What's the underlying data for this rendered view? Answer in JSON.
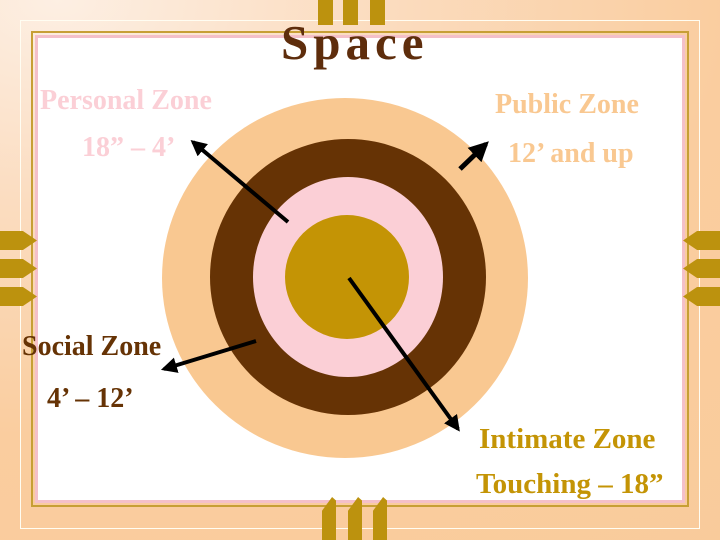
{
  "slide": {
    "title": "Space"
  },
  "zones": [
    {
      "name": "Personal Zone",
      "range": "18” – 4’",
      "color": "#FBCFD6"
    },
    {
      "name": "Public Zone",
      "range": "12’ and up",
      "color": "#F9C891"
    },
    {
      "name": "Social Zone",
      "range": "4’ – 12’",
      "color": "#663305"
    },
    {
      "name": "Intimate Zone",
      "range": "Touching – 18”",
      "color": "#C49405"
    }
  ],
  "theme": {
    "title_brown": "#5E2D0C",
    "frame_gold": "#C79F35",
    "frame_pink": "#F4C0C9",
    "frame_cream": "#FFFDF2",
    "bar_gold": "#BC920E",
    "arrow_black": "#000000"
  }
}
